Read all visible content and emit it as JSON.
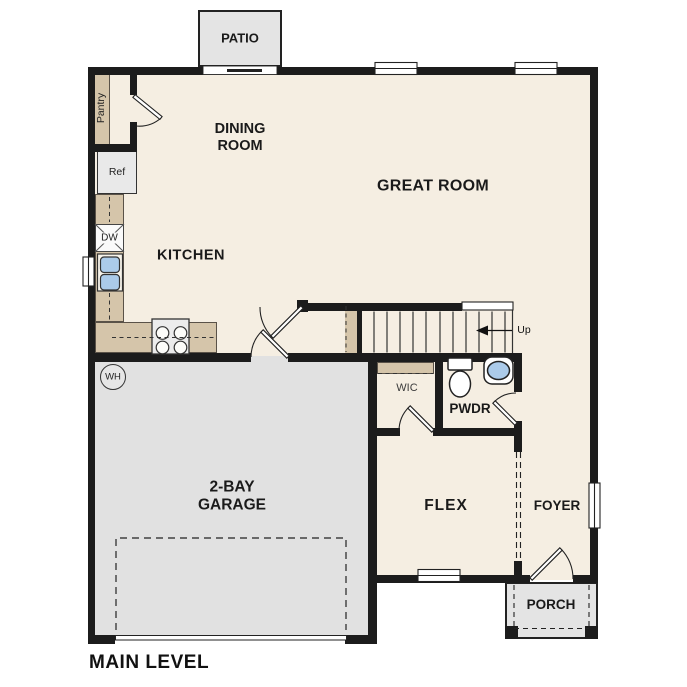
{
  "plan": {
    "level_title": "MAIN LEVEL"
  },
  "rooms": {
    "patio": "PATIO",
    "dining_line1": "DINING",
    "dining_line2": "ROOM",
    "great_room": "GREAT ROOM",
    "kitchen": "KITCHEN",
    "garage_line1": "2-BAY",
    "garage_line2": "GARAGE",
    "flex": "FLEX",
    "foyer": "FOYER",
    "porch": "PORCH",
    "pwdr": "PWDR",
    "wic": "WIC"
  },
  "fixtures": {
    "pantry": "Pantry",
    "refrigerator": "Ref",
    "dishwasher": "DW",
    "water_heater": "WH",
    "stairs_direction": "Up"
  },
  "colors": {
    "wall": "#1c1c1c",
    "floor": "#f5eee2",
    "garage_floor": "#e1e1e1",
    "outdoor_concrete": "#e4e4e4",
    "counter_tan": "#d5c5aa",
    "basin_blue": "#abcbea"
  }
}
